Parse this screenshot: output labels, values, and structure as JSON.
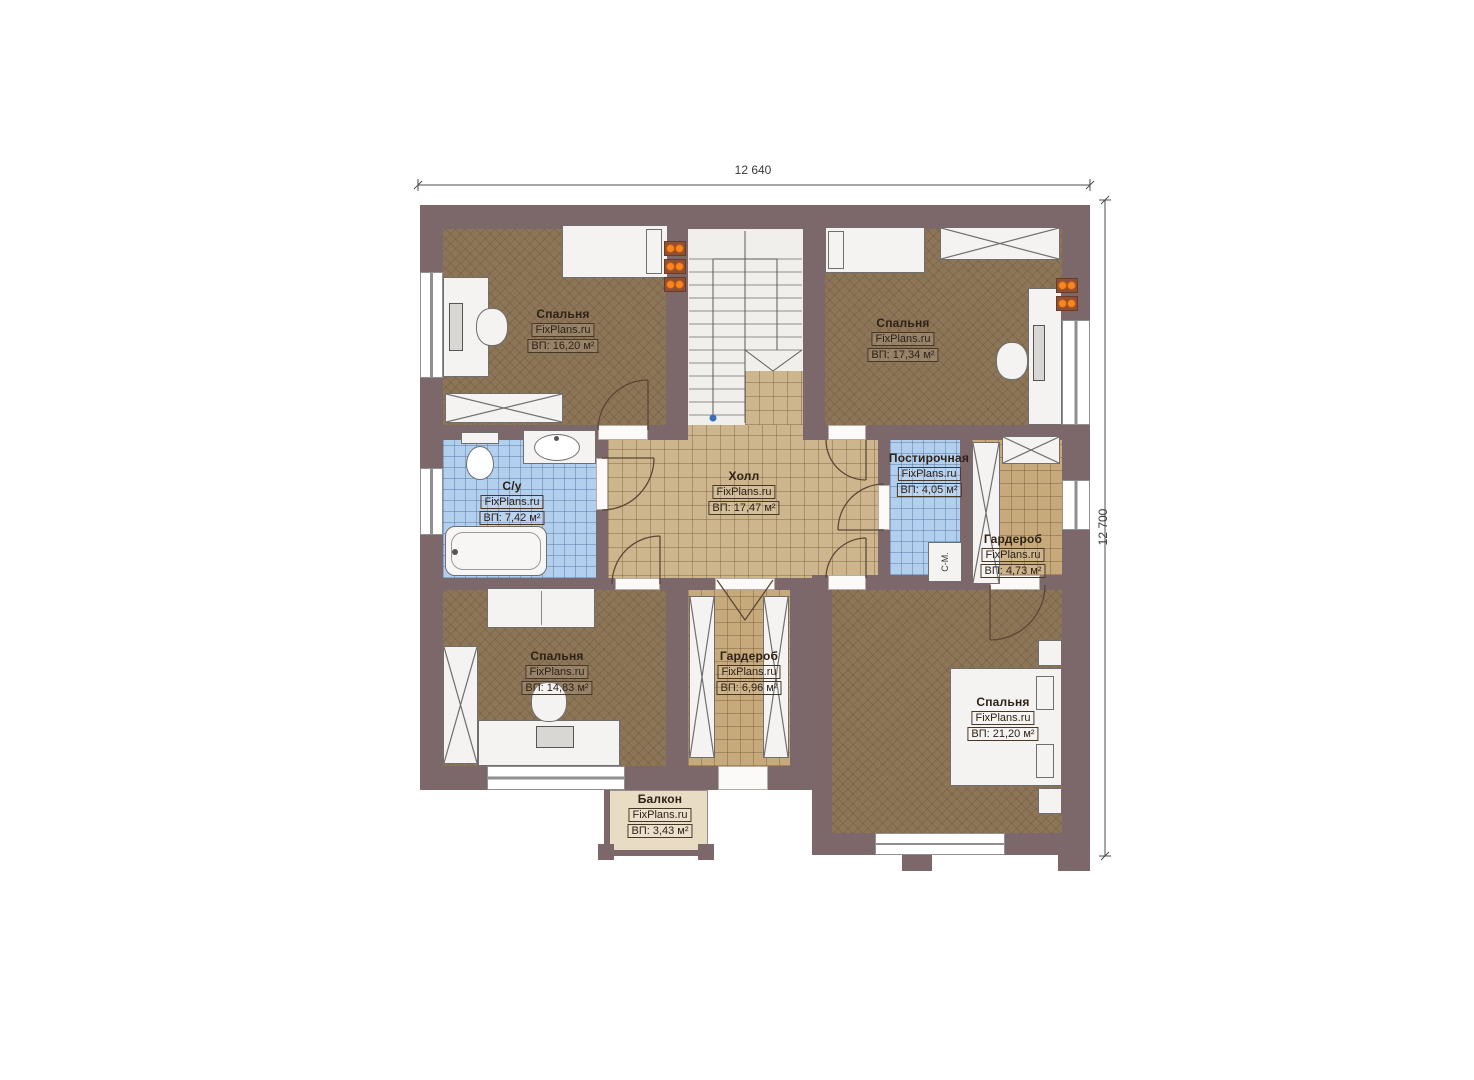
{
  "dimensions": {
    "width_label": "12 640",
    "height_label": "12 700"
  },
  "brand": "FixPlans.ru",
  "rooms": {
    "bedroom_tl": {
      "name": "Спальня",
      "area": "ВП: 16,20 м²"
    },
    "bedroom_tr": {
      "name": "Спальня",
      "area": "ВП: 17,34 м²"
    },
    "bathroom": {
      "name": "С/у",
      "area": "ВП: 7,42 м²"
    },
    "hall": {
      "name": "Холл",
      "area": "ВП: 17,47 м²"
    },
    "laundry": {
      "name": "Постирочная",
      "area": "ВП: 4,05 м²"
    },
    "wardrobe_right": {
      "name": "Гардероб",
      "area": "ВП: 4,73 м²"
    },
    "bedroom_bl": {
      "name": "Спальня",
      "area": "ВП: 14,83 м²"
    },
    "wardrobe_center": {
      "name": "Гардероб",
      "area": "ВП: 6,96 м²"
    },
    "bedroom_br": {
      "name": "Спальня",
      "area": "ВП: 21,20 м²"
    },
    "balcony": {
      "name": "Балкон",
      "area": "ВП: 3,43 м²"
    }
  },
  "annotations": {
    "washing_machine": "С-М."
  },
  "colors": {
    "wall": "#7c686a",
    "bedroom_floor": "#8d7557",
    "tile_floor": "#cdb68d",
    "wet_floor": "#b2cfee",
    "balcony_floor": "#e9dcc5",
    "radiator": "#f6861f",
    "stair_marker": "#3b6cb4"
  }
}
